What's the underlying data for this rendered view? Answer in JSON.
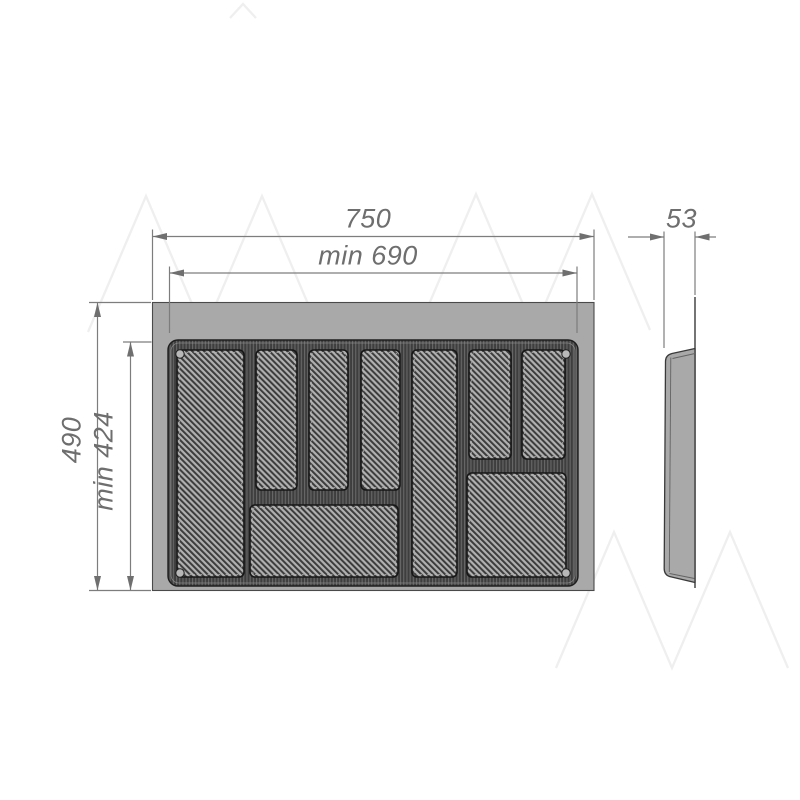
{
  "drawing": {
    "kind": "technical-drawing",
    "subject": "cutlery tray insert, front view with compartments and side profile view",
    "dims": {
      "total_width": "750",
      "min_width": "min 690",
      "total_height": "490",
      "min_height": "min 424",
      "depth": "53"
    },
    "colors": {
      "background": "#ffffff",
      "body_fill": "#a9a9a9",
      "recess_dark": "#3e3e3e",
      "outline": "#3a3a3a",
      "dim_line": "#7d7d7d",
      "dim_text": "#6e6e6e",
      "watermark": "#efefef"
    },
    "compartment_count": 9
  }
}
